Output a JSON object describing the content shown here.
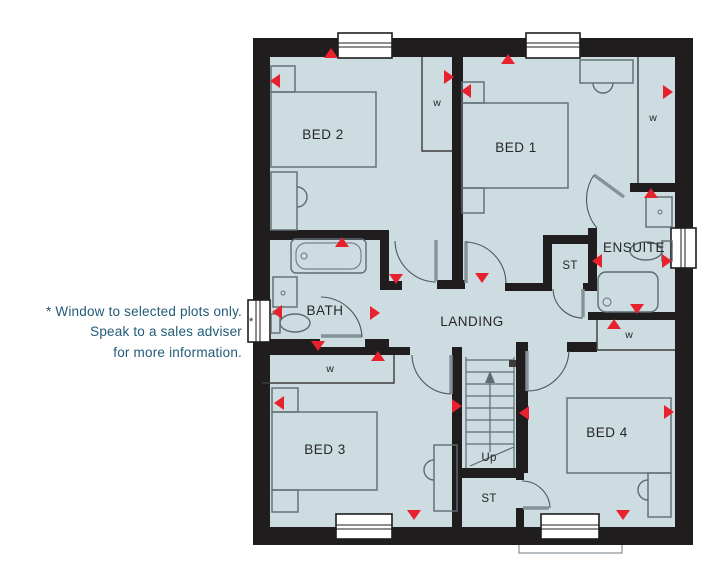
{
  "note": {
    "line1": "* Window to selected plots only.",
    "line2": "Speak to a sales adviser",
    "line3": "for more information."
  },
  "rooms": {
    "bed1": "BED 1",
    "bed2": "BED 2",
    "bed3": "BED 3",
    "bed4": "BED 4",
    "bath": "BATH",
    "ensuite": "ENSUITE",
    "landing": "LANDING"
  },
  "labels": {
    "stairs_up": "Up",
    "storage_upper": "ST",
    "storage_lower": "ST",
    "wardrobe": "w",
    "window_asterisk": "*"
  },
  "colors": {
    "floor_fill": "#ccdce1",
    "wall": "#1f1d1e",
    "alarm_marker": "#e8212e",
    "note_text": "#215b78",
    "furniture_line": "#5d6b73"
  }
}
